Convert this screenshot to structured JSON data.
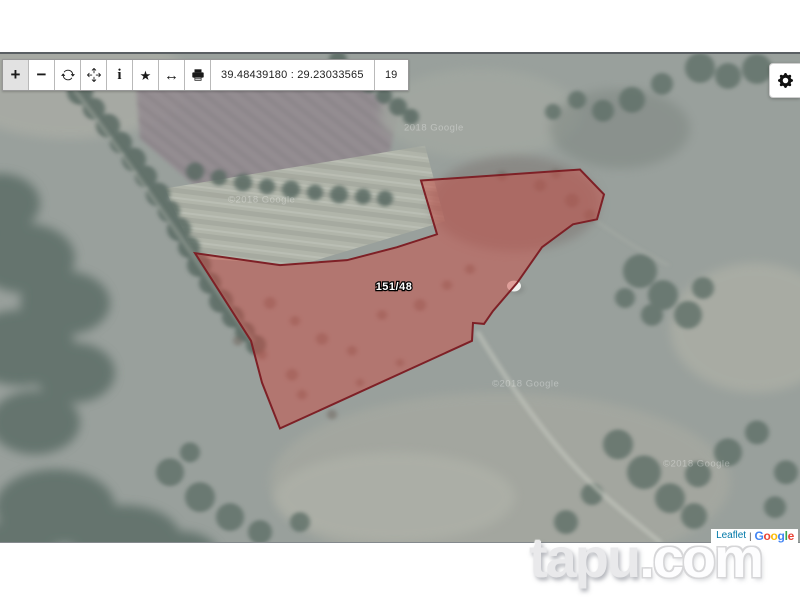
{
  "toolbar": {
    "buttons": [
      {
        "name": "zoom-in",
        "icon": "plus-icon",
        "label": "+"
      },
      {
        "name": "zoom-out",
        "icon": "minus-icon",
        "label": "−"
      },
      {
        "name": "refresh",
        "icon": "refresh-icon"
      },
      {
        "name": "move",
        "icon": "move-icon"
      },
      {
        "name": "info",
        "icon": "info-icon",
        "label": "i"
      },
      {
        "name": "favorite",
        "icon": "star-icon",
        "label": "★"
      },
      {
        "name": "measure",
        "icon": "left-right-arrow-icon",
        "label": "↔"
      },
      {
        "name": "print",
        "icon": "printer-icon"
      }
    ],
    "coordinates": "39.48439180 : 29.23033565",
    "zoom_level": "19"
  },
  "settings": {
    "icon": "gear-icon"
  },
  "map": {
    "parcel": {
      "label": "151/48",
      "points": "421,127 580,116 604,141 597,166 573,171 542,194 517,230 493,258 484,271 473,270 472,288 280,376 262,330 251,288 195,200 280,212 347,207 397,194 437,181",
      "fill": "rgba(203,75,68,0.5)",
      "stroke": "#7e2026"
    },
    "google_watermarks": [
      "©2018 Google",
      "2018 Google",
      "©2018 Google",
      "©2018 Google"
    ]
  },
  "attribution": {
    "leaflet": "Leaflet",
    "separator": "|",
    "google_letters": [
      {
        "ch": "G",
        "color": "#4285F4"
      },
      {
        "ch": "o",
        "color": "#EA4335"
      },
      {
        "ch": "o",
        "color": "#FBBC05"
      },
      {
        "ch": "g",
        "color": "#4285F4"
      },
      {
        "ch": "l",
        "color": "#34A853"
      },
      {
        "ch": "e",
        "color": "#EA4335"
      }
    ]
  },
  "site_watermark": {
    "brand": "tapu",
    "suffix": ".com"
  }
}
